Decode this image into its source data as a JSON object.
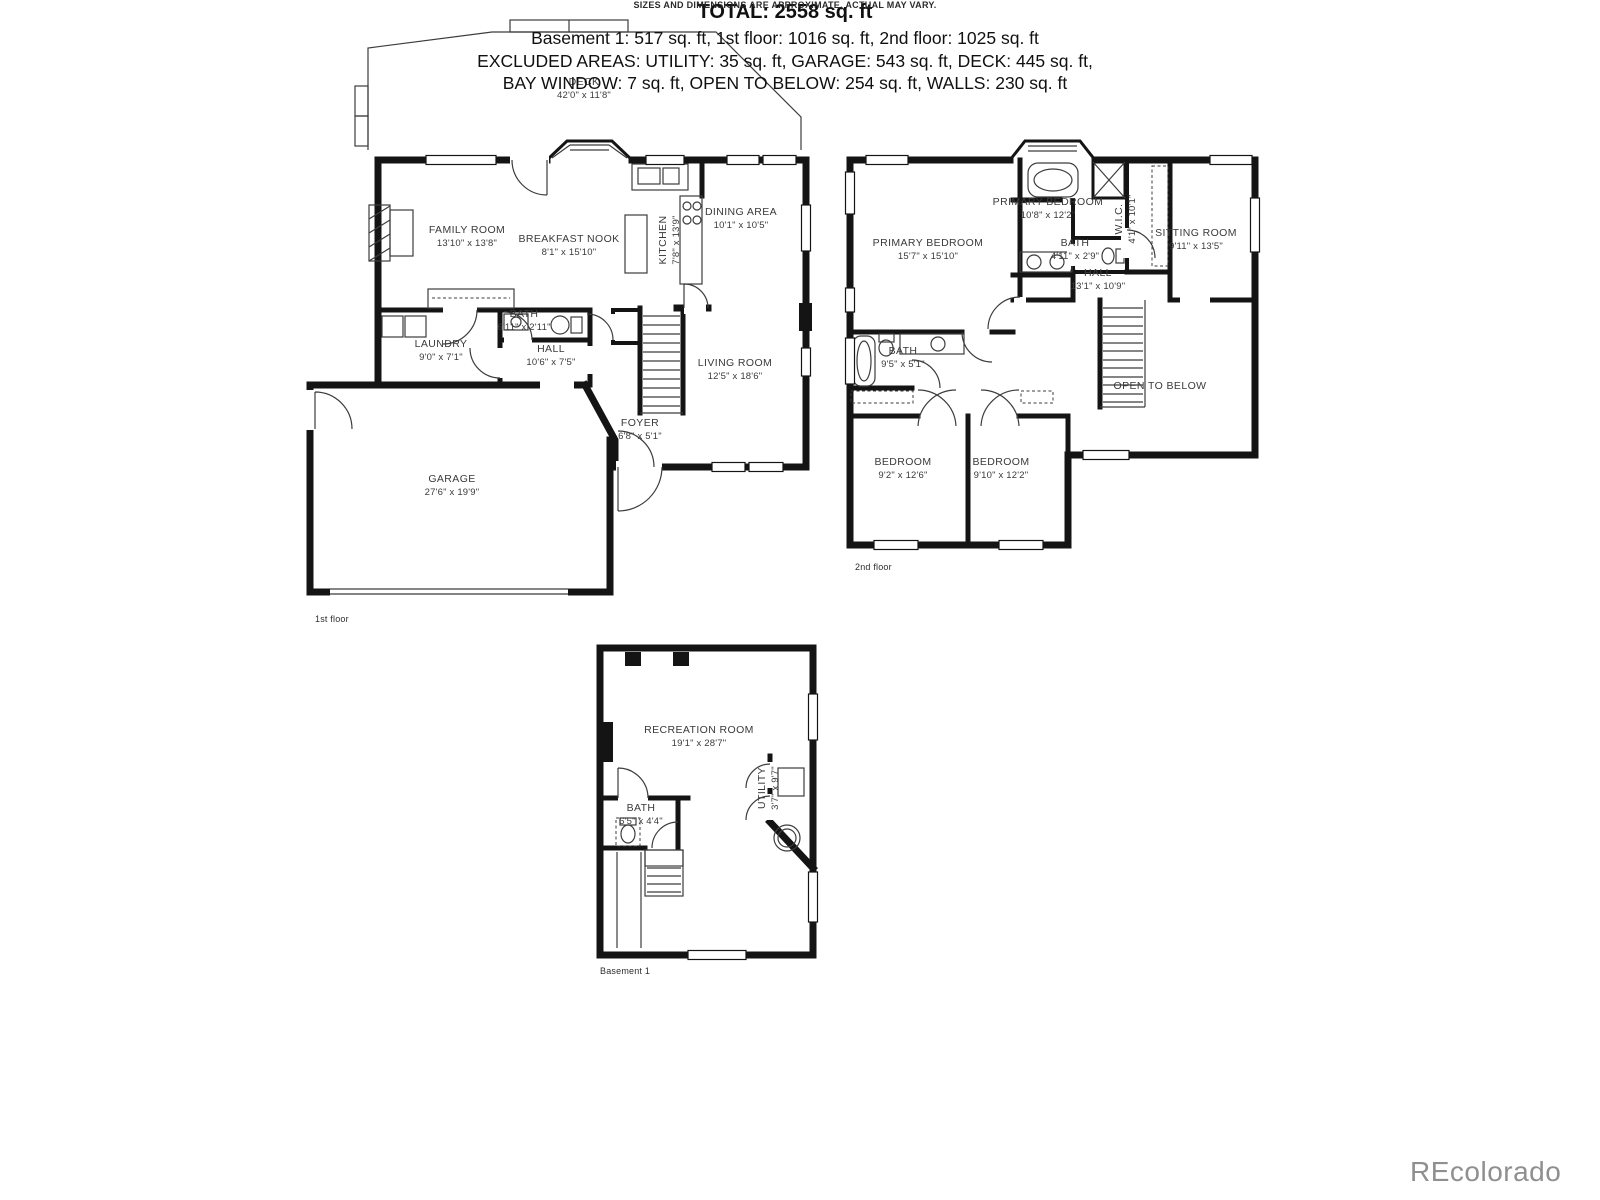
{
  "floors": [
    {
      "label": "1st floor",
      "rooms": [
        {
          "name": "DECK",
          "dims": "42'0\" x 11'8\""
        },
        {
          "name": "FAMILY ROOM",
          "dims": "13'10\" x 13'8\""
        },
        {
          "name": "BREAKFAST NOOK",
          "dims": "8'1\" x 15'10\""
        },
        {
          "name": "KITCHEN",
          "dims": "7'8\" x 13'9\""
        },
        {
          "name": "DINING AREA",
          "dims": "10'1\" x 10'5\""
        },
        {
          "name": "LIVING ROOM",
          "dims": "12'5\" x 18'6\""
        },
        {
          "name": "LAUNDRY",
          "dims": "9'0\" x 7'1\""
        },
        {
          "name": "BATH",
          "dims": "6'11\" x 2'11\""
        },
        {
          "name": "HALL",
          "dims": "10'6\" x 7'5\""
        },
        {
          "name": "FOYER",
          "dims": "6'8\" x 5'1\""
        },
        {
          "name": "GARAGE",
          "dims": "27'6\" x 19'9\""
        }
      ]
    },
    {
      "label": "2nd floor",
      "rooms": [
        {
          "name": "PRIMARY BEDROOM",
          "dims": "10'8\" x 12'2\""
        },
        {
          "name": "PRIMARY BEDROOM",
          "dims": "15'7\" x 15'10\""
        },
        {
          "name": "BATH",
          "dims": "4'11\" x 2'9\""
        },
        {
          "name": "W.I.C.",
          "dims": "4'1\" x 10'1\""
        },
        {
          "name": "SITTING ROOM",
          "dims": "9'11\" x 13'5\""
        },
        {
          "name": "HALL",
          "dims": "13'1\" x 10'9\""
        },
        {
          "name": "BATH",
          "dims": "9'5\" x 5'1\""
        },
        {
          "name": "BEDROOM",
          "dims": "9'2\" x 12'6\""
        },
        {
          "name": "BEDROOM",
          "dims": "9'10\" x 12'2\""
        },
        {
          "name": "OPEN TO BELOW",
          "dims": ""
        }
      ]
    },
    {
      "label": "Basement 1",
      "rooms": [
        {
          "name": "RECREATION ROOM",
          "dims": "19'1\" x 28'7\""
        },
        {
          "name": "BATH",
          "dims": "6'5\" x 4'4\""
        },
        {
          "name": "UTILITY",
          "dims": "3'7\" x 9'7\""
        }
      ]
    }
  ],
  "summary": {
    "total": "TOTAL: 2558 sq. ft",
    "floor_areas": "Basement 1: 517 sq. ft, 1st floor: 1016 sq. ft, 2nd floor: 1025 sq. ft",
    "excluded_1": "EXCLUDED AREAS: UTILITY: 35 sq. ft, GARAGE: 543 sq. ft, DECK: 445 sq. ft,",
    "excluded_2": "BAY WINDOW: 7 sq. ft, OPEN TO BELOW: 254 sq. ft, WALLS: 230 sq. ft"
  },
  "disclaimer": "SIZES AND DIMENSIONS ARE APPROXIMATE, ACTUAL MAY VARY.",
  "watermark": "REcolorado",
  "colors": {
    "wall": "#141414",
    "thin_line": "#3c3c3c",
    "label": "#3a3a3a",
    "watermark": "#8f8f8f"
  }
}
